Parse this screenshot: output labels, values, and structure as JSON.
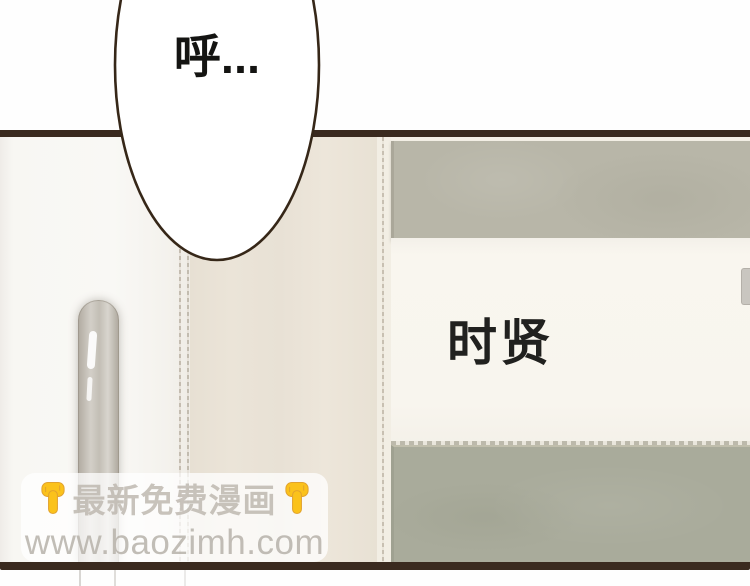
{
  "scene": {
    "speech_bubble": {
      "text": "呼..."
    },
    "name_plate": {
      "text": "时贤"
    }
  },
  "watermark": {
    "line1": "最新免费漫画",
    "line2": "www.baozimh.com",
    "left_icon": "pointing-down-hand",
    "right_icon": "pointing-down-hand"
  },
  "palette": {
    "panel_border": "#3a2a1f",
    "door": "#f8f7f3",
    "door_handle": "#c9c4bc",
    "wall": "#e9e2d6",
    "upper_band": "#b8b6a8",
    "lower_band": "#a9ab9b",
    "plate_background": "#f8f5ee",
    "ink_text": "#1c1c1a",
    "watermark_text": "#bab4ab",
    "hand_yellow": "#fbc21b",
    "hand_outline": "#e2a32e"
  }
}
